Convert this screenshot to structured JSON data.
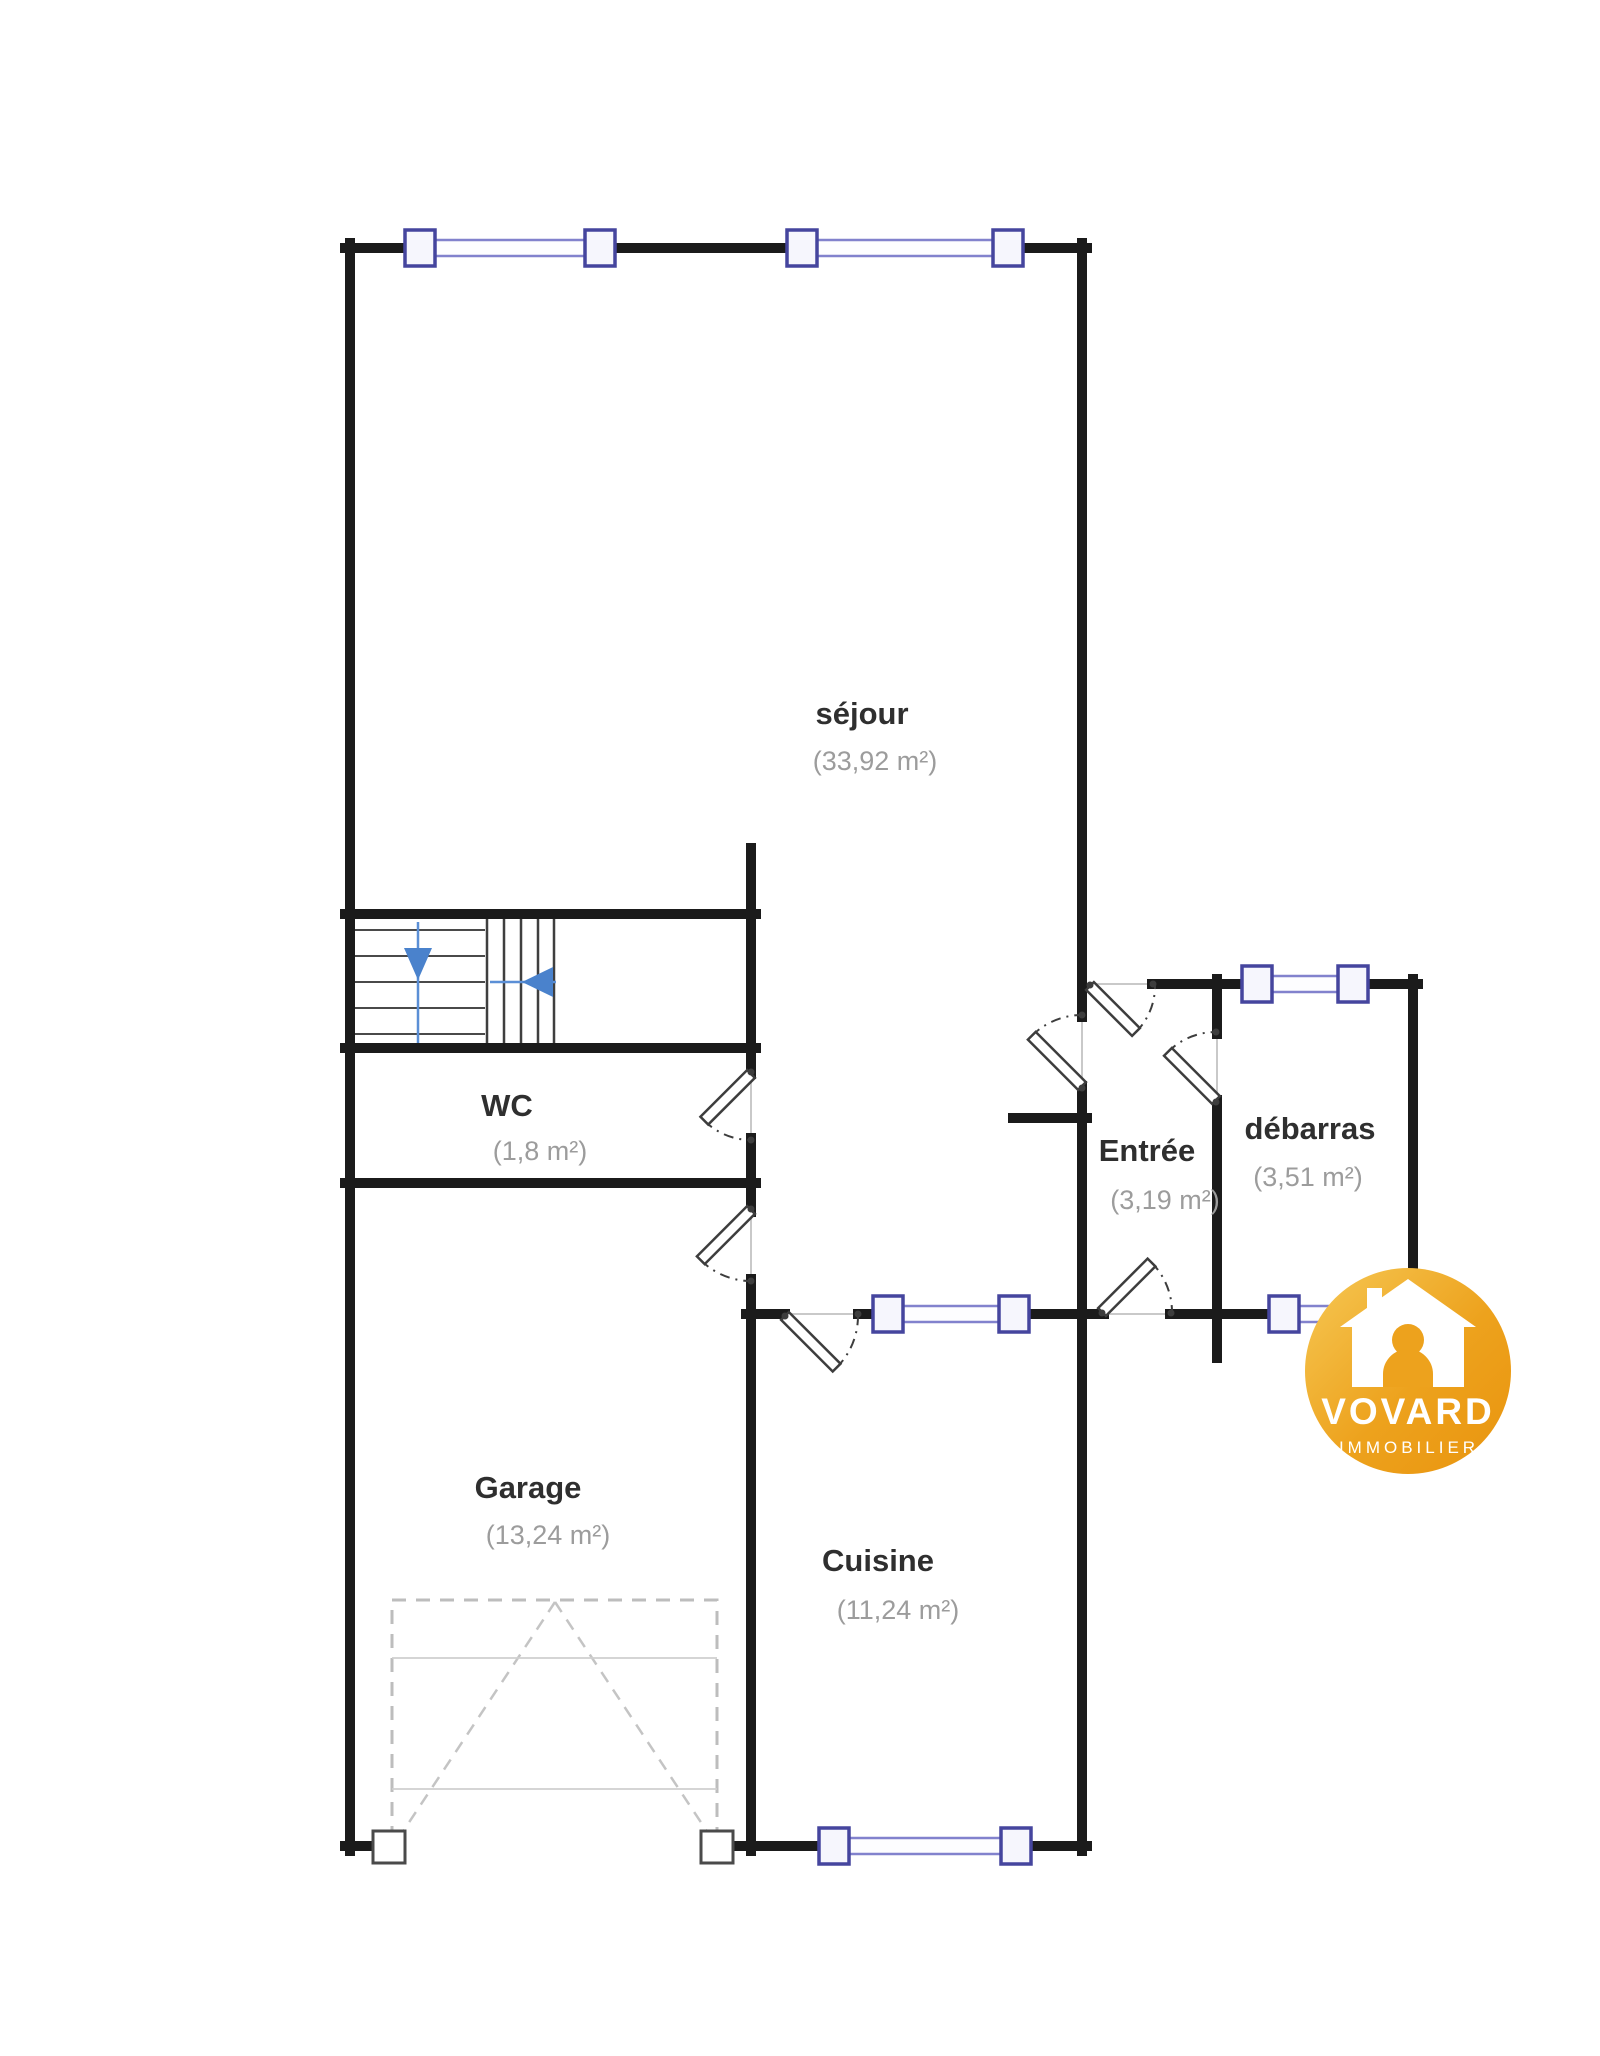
{
  "rooms": {
    "sejour": {
      "name": "séjour",
      "area": "(33,92 m²)"
    },
    "wc": {
      "name": "WC",
      "area": "(1,8 m²)"
    },
    "garage": {
      "name": "Garage",
      "area": "(13,24 m²)"
    },
    "cuisine": {
      "name": "Cuisine",
      "area": "(11,24 m²)"
    },
    "entree": {
      "name": "Entrée",
      "area": "(3,19 m²)"
    },
    "debarras": {
      "name": "débarras",
      "area": "(3,51 m²)"
    }
  },
  "logo": {
    "brand": "VOVARD",
    "tagline": "IMMOBILIER",
    "gold_light": "#f6c550",
    "gold_mid": "#eda21d",
    "gold_dark": "#e9940e"
  },
  "colors": {
    "wall": "#1b1b1b",
    "window_frame": "#45459e",
    "window_band": "#8282cd",
    "stair_arrow_blue": "#4a82cc",
    "room_name_text": "#2f2f2f",
    "room_area_text": "#9c9c9c",
    "garage_door_dash": "#bdbdbd",
    "background": "#ffffff"
  }
}
